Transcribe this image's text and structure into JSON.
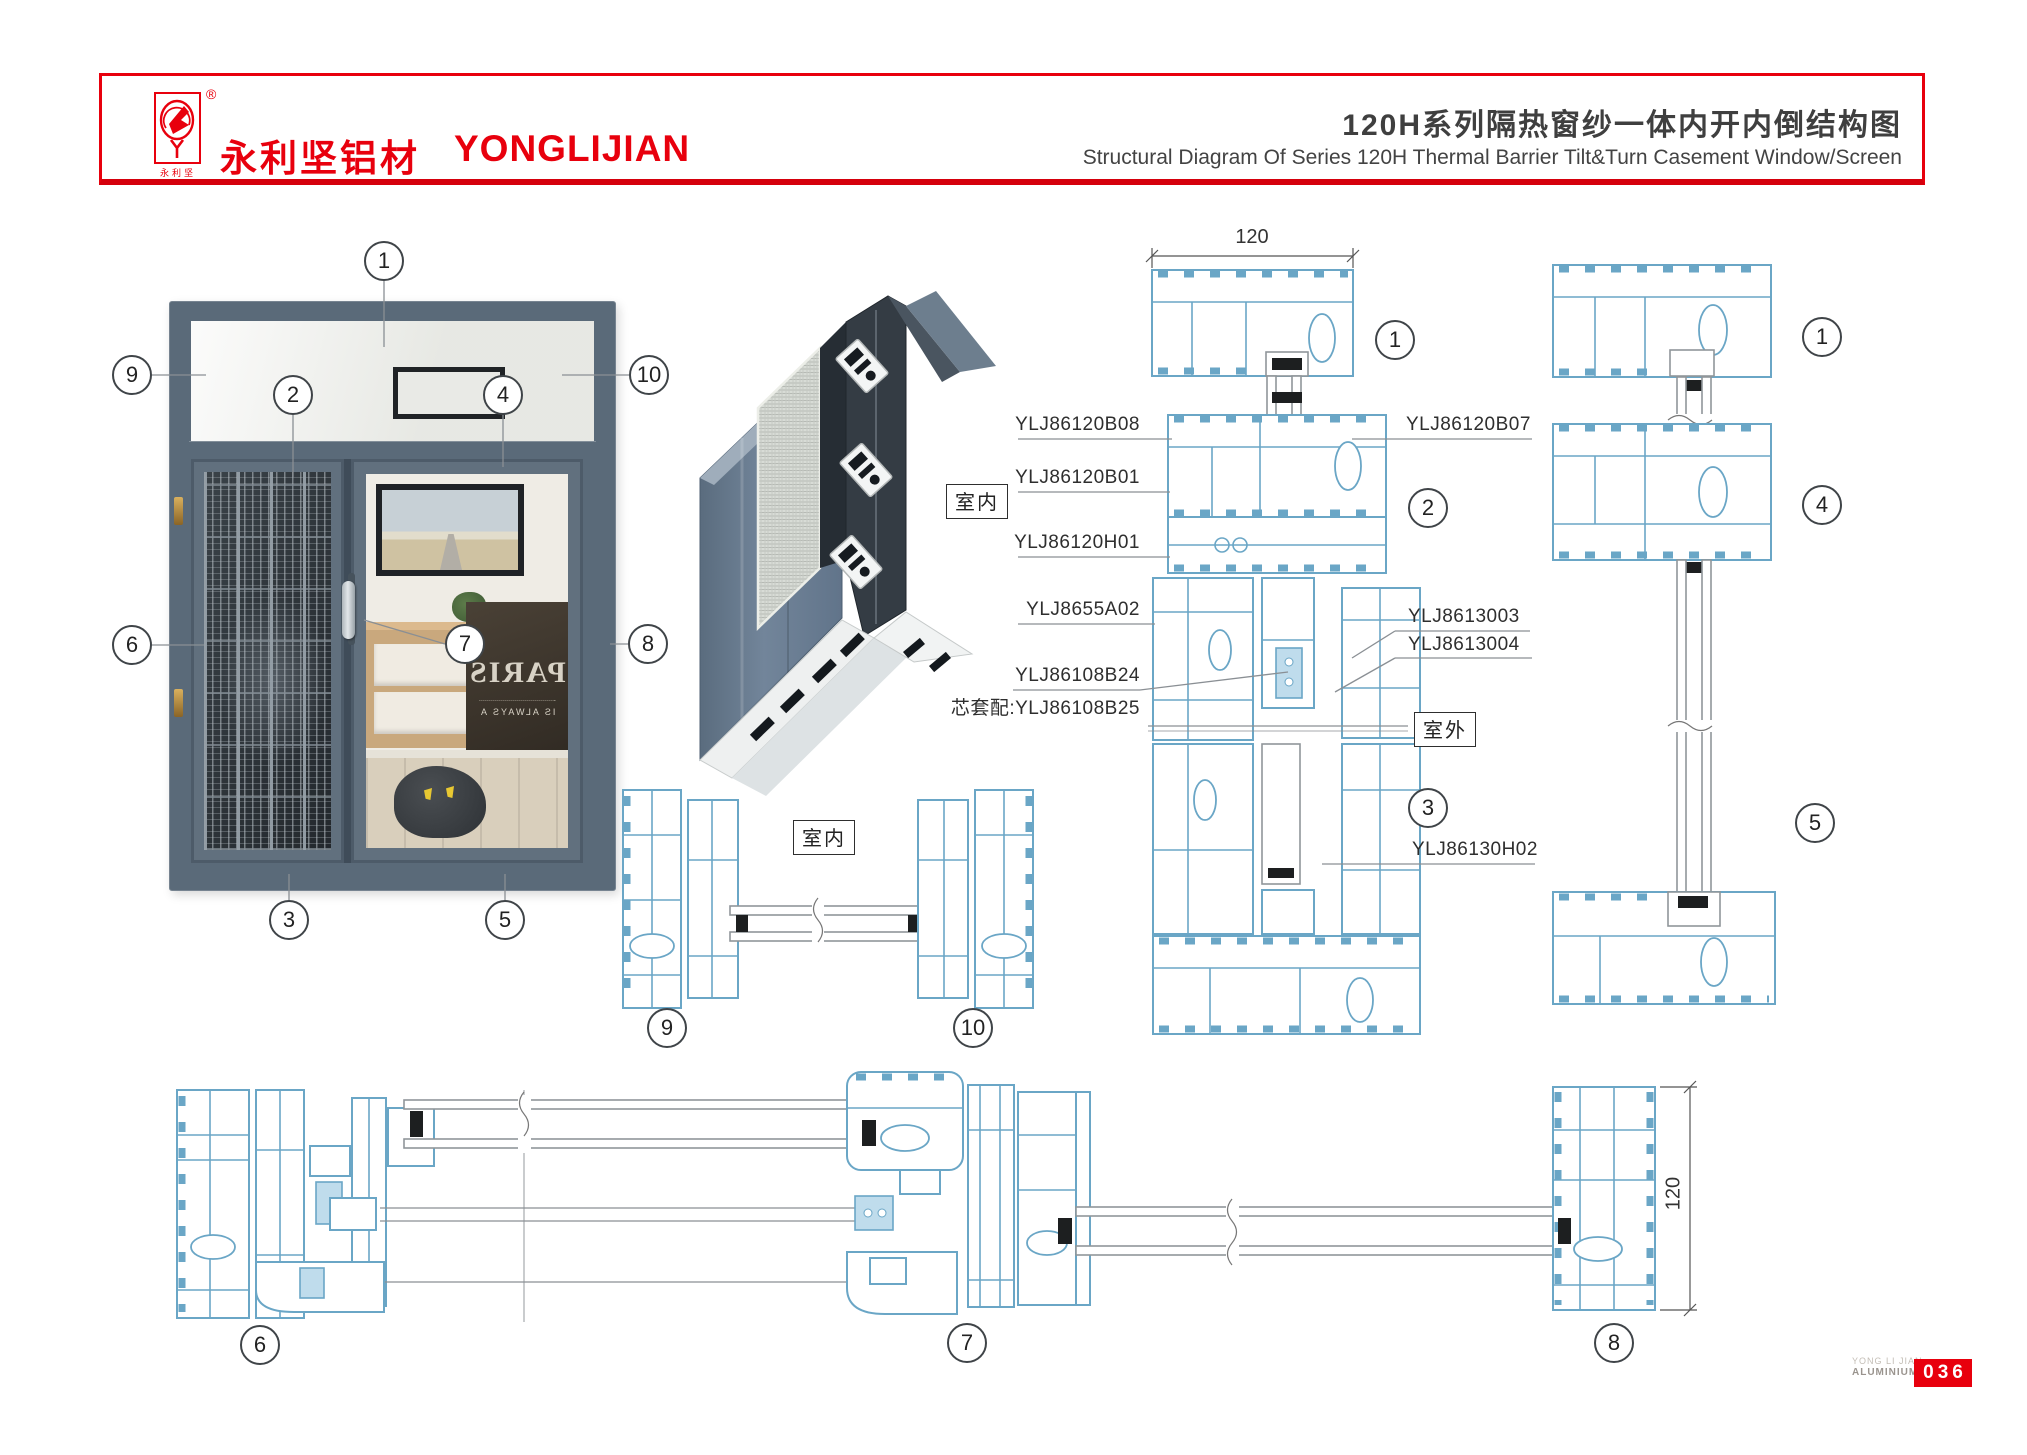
{
  "header": {
    "brand_cn": "永利坚铝材",
    "brand_en": "YONGLIJIAN",
    "registered_mark": "®",
    "logo_caption": "永利坚",
    "title_cn": "120H系列隔热窗纱一体内开内倒结构图",
    "title_en": "Structural Diagram Of Series 120H Thermal Barrier Tilt&Turn Casement Window/Screen",
    "accent_color": "#e8000d"
  },
  "labels": {
    "indoor_render": "室内",
    "indoor_section": "室内",
    "outdoor": "室外"
  },
  "parts_left": [
    {
      "code": "YLJ86120B08"
    },
    {
      "code": "YLJ86120B01"
    },
    {
      "code": "YLJ86120H01"
    },
    {
      "code": "YLJ8655A02"
    },
    {
      "code": "YLJ86108B24"
    },
    {
      "code": "芯套配:YLJ86108B25"
    }
  ],
  "parts_right": [
    {
      "code": "YLJ86120B07"
    },
    {
      "code": "YLJ8613003"
    },
    {
      "code": "YLJ8613004"
    },
    {
      "code": "YLJ86130H02"
    }
  ],
  "dimensions": {
    "head_width": "120",
    "frame_depth": "120"
  },
  "callouts": {
    "c1": "1",
    "c2": "2",
    "c3": "3",
    "c4": "4",
    "c5": "5",
    "c6": "6",
    "c7": "7",
    "c8": "8",
    "c9": "9",
    "c10": "10"
  },
  "reflection": {
    "poster_main": "PARIS",
    "poster_sub": "IS ALWAYS A"
  },
  "footer": {
    "brand_top": "YONG LI JIAN",
    "brand_bottom": "ALUMINIUM",
    "page_no": "036"
  },
  "drawing_colors": {
    "profile_stroke": "#6aa6c6",
    "highlight_fill": "#bfdcec",
    "frame_render": "#5a6a79"
  }
}
